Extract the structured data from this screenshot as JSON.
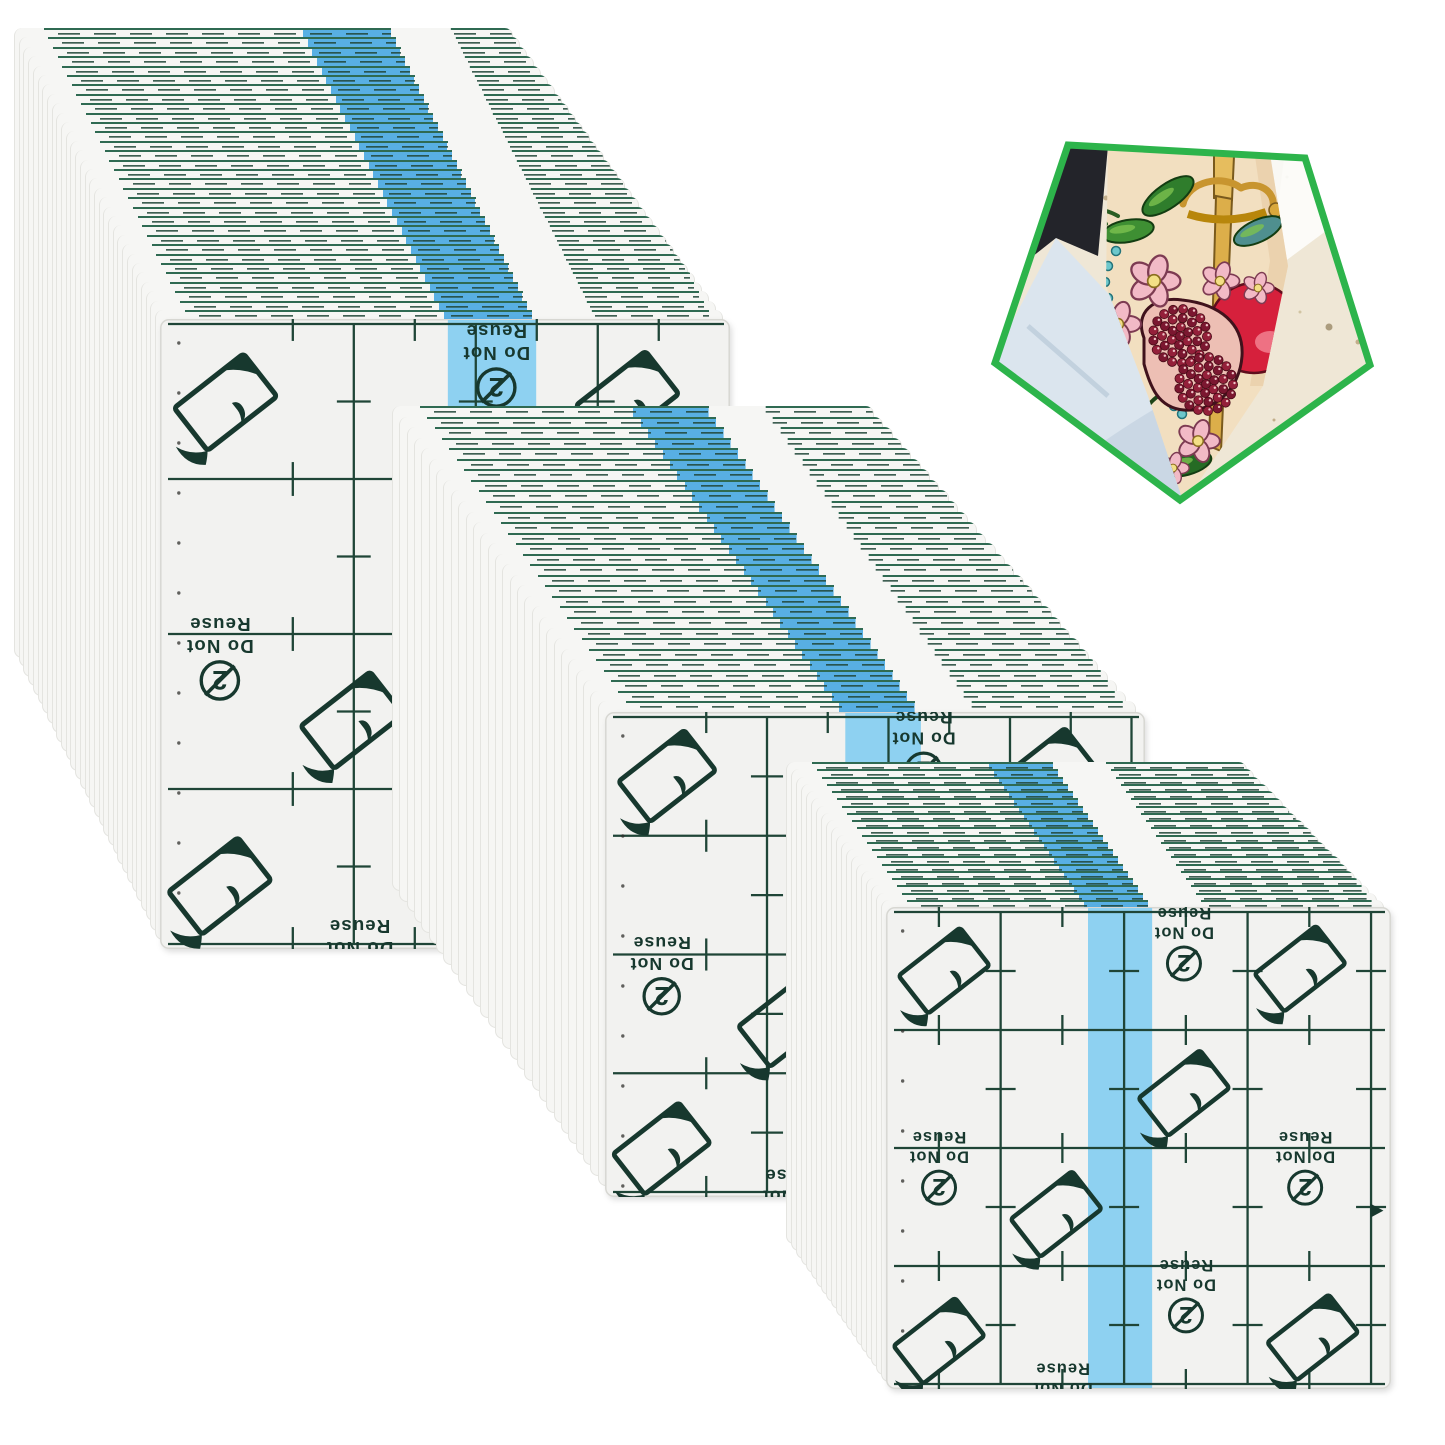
{
  "canvas": {
    "width": 1445,
    "height": 1445,
    "background": "#ffffff"
  },
  "product": {
    "name": "Transparent waterproof tattoo aftercare film sheets, three fanned stacks",
    "sheet_print": {
      "line1": "Do Not",
      "line2": "Reuse",
      "digit": "2"
    }
  },
  "colors": {
    "sheet": "#f2f2f0",
    "sheet_fan": "#f6f6f4",
    "sheet_border": "#d7d7d2",
    "grid": "#1f4537",
    "print": "#17382e",
    "stripe_front": "#86cef1",
    "stripe_fan": "#58afe3",
    "fan_line": "#2f6a52",
    "badge_border": "#2db44b",
    "skin": "#f2dfc0",
    "denim": "#dbe5ee",
    "floor": "#efe7d6",
    "pomegranate": "#d6203c",
    "seed": "#8e1b31",
    "leaf": "#2f7d2c",
    "gold": "#dcae4a",
    "flower": "#f2bac6",
    "bead": "#6cc7cc"
  },
  "stacks": [
    {
      "name": "stack-top-left",
      "x": 14,
      "y": 28,
      "count": 32,
      "dx": 4.7,
      "dy": 9.4,
      "sheet_w": 570,
      "sheet_h": 630,
      "shrink": 2.3,
      "stripe_x": 0.505,
      "stripe_w": 0.155,
      "grid_x0": 0.34,
      "grid_pitch": 0.214
    },
    {
      "name": "stack-middle",
      "x": 392,
      "y": 406,
      "count": 30,
      "dx": 7.35,
      "dy": 10.55,
      "sheet_w": 540,
      "sheet_h": 485,
      "shrink": 2.0,
      "stripe_x": 0.445,
      "stripe_w": 0.14,
      "grid_x0": 0.3,
      "grid_pitch": 0.225
    },
    {
      "name": "stack-bottom-right",
      "x": 786,
      "y": 762,
      "count": 21,
      "dx": 5.0,
      "dy": 7.25,
      "sheet_w": 505,
      "sheet_h": 482,
      "shrink": 2.2,
      "stripe_x": 0.4,
      "stripe_w": 0.127,
      "grid_x0": 0.227,
      "grid_pitch": 0.2445
    }
  ],
  "sheet_pattern": {
    "peel_icon_positions": [
      [
        0.115,
        0.132
      ],
      [
        0.82,
        0.128
      ],
      [
        0.59,
        0.386
      ],
      [
        0.337,
        0.637
      ],
      [
        0.105,
        0.9
      ],
      [
        0.845,
        0.893
      ]
    ],
    "reuse_icon_positions": [
      [
        0.59,
        0.055
      ],
      [
        0.105,
        0.52
      ],
      [
        0.83,
        0.52
      ],
      [
        0.594,
        0.785
      ],
      [
        0.35,
        1.0
      ]
    ],
    "edge_arrow": {
      "x": 0.985,
      "y": 0.63
    }
  },
  "badge": {
    "x": 958,
    "y": 96,
    "width": 456,
    "height": 420,
    "border_color": "#2db44b",
    "subject": "tattooed leg with pomegranate, flowers and dagger tattoo, denim jeans, terrazzo floor"
  }
}
